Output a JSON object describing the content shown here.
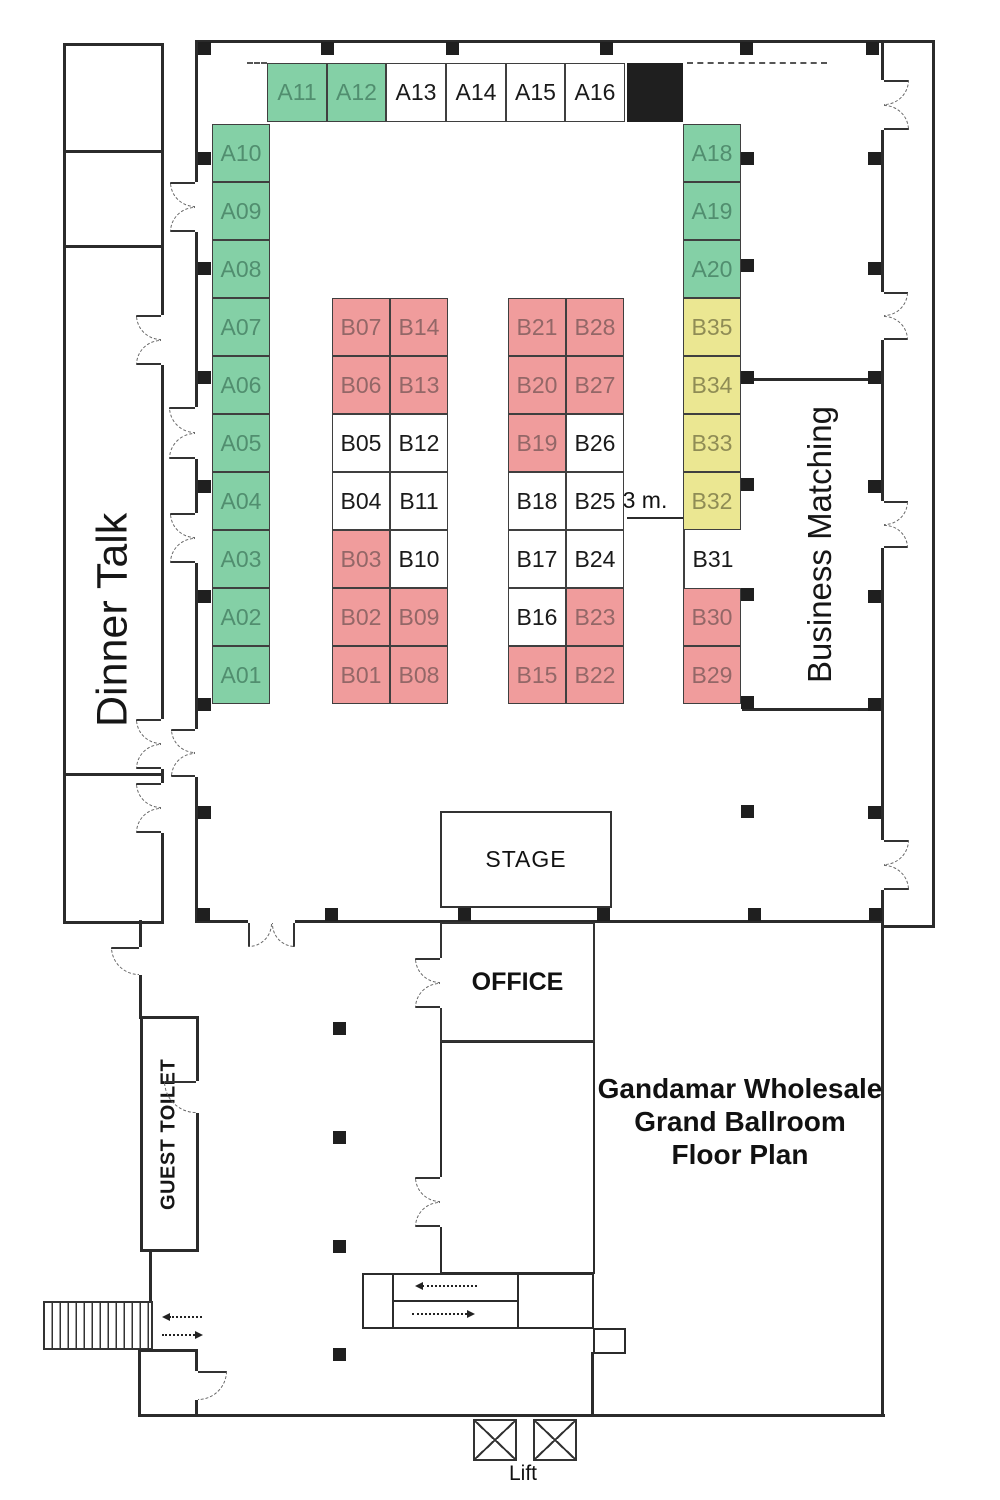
{
  "title": {
    "lines": [
      "Gandamar Wholesale",
      "Grand Ballroom",
      "Floor Plan"
    ]
  },
  "labels": {
    "dinner_talk": "Dinner Talk",
    "business_matching": "Business Matching",
    "guest_toilet": "GUEST TOILET",
    "stage": "STAGE",
    "office": "OFFICE",
    "lift": "Lift",
    "aisle_width": "3 m."
  },
  "colors": {
    "wall": "#2b2b2b",
    "solid_block": "#1f1f1f",
    "booth_green": "#84d0a6",
    "booth_green_text": "#518e6f",
    "booth_pink": "#f09c9c",
    "booth_pink_text": "#936767",
    "booth_yellow": "#ebe792",
    "booth_yellow_text": "#8f8c55"
  },
  "booths": [
    {
      "id": "A11",
      "x": 267,
      "y": 63,
      "w": 60,
      "h": 59,
      "type": "green"
    },
    {
      "id": "A12",
      "x": 327,
      "y": 63,
      "w": 59,
      "h": 59,
      "type": "green"
    },
    {
      "id": "A13",
      "x": 386,
      "y": 63,
      "w": 60,
      "h": 59,
      "type": "white"
    },
    {
      "id": "A14",
      "x": 446,
      "y": 63,
      "w": 60,
      "h": 59,
      "type": "white"
    },
    {
      "id": "A15",
      "x": 506,
      "y": 63,
      "w": 59,
      "h": 59,
      "type": "white"
    },
    {
      "id": "A16",
      "x": 565,
      "y": 63,
      "w": 60,
      "h": 59,
      "type": "white"
    },
    {
      "id": "",
      "x": 627,
      "y": 63,
      "w": 56,
      "h": 59,
      "type": "solid"
    },
    {
      "id": "A10",
      "x": 212,
      "y": 124,
      "w": 58,
      "h": 58,
      "type": "green"
    },
    {
      "id": "A09",
      "x": 212,
      "y": 182,
      "w": 58,
      "h": 58,
      "type": "green"
    },
    {
      "id": "A08",
      "x": 212,
      "y": 240,
      "w": 58,
      "h": 58,
      "type": "green"
    },
    {
      "id": "A07",
      "x": 212,
      "y": 298,
      "w": 58,
      "h": 58,
      "type": "green"
    },
    {
      "id": "A06",
      "x": 212,
      "y": 356,
      "w": 58,
      "h": 58,
      "type": "green"
    },
    {
      "id": "A05",
      "x": 212,
      "y": 414,
      "w": 58,
      "h": 58,
      "type": "green"
    },
    {
      "id": "A04",
      "x": 212,
      "y": 472,
      "w": 58,
      "h": 58,
      "type": "green"
    },
    {
      "id": "A03",
      "x": 212,
      "y": 530,
      "w": 58,
      "h": 58,
      "type": "green"
    },
    {
      "id": "A02",
      "x": 212,
      "y": 588,
      "w": 58,
      "h": 58,
      "type": "green"
    },
    {
      "id": "A01",
      "x": 212,
      "y": 646,
      "w": 58,
      "h": 58,
      "type": "green"
    },
    {
      "id": "A18",
      "x": 683,
      "y": 124,
      "w": 58,
      "h": 58,
      "type": "green"
    },
    {
      "id": "A19",
      "x": 683,
      "y": 182,
      "w": 58,
      "h": 58,
      "type": "green"
    },
    {
      "id": "A20",
      "x": 683,
      "y": 240,
      "w": 58,
      "h": 58,
      "type": "green"
    },
    {
      "id": "B35",
      "x": 683,
      "y": 298,
      "w": 58,
      "h": 58,
      "type": "yellow"
    },
    {
      "id": "B34",
      "x": 683,
      "y": 356,
      "w": 58,
      "h": 58,
      "type": "yellow"
    },
    {
      "id": "B33",
      "x": 683,
      "y": 414,
      "w": 58,
      "h": 58,
      "type": "yellow"
    },
    {
      "id": "B32",
      "x": 683,
      "y": 472,
      "w": 58,
      "h": 58,
      "type": "yellow"
    },
    {
      "id": "B31",
      "x": 683,
      "y": 530,
      "w": 58,
      "h": 58,
      "type": "open"
    },
    {
      "id": "B30",
      "x": 683,
      "y": 588,
      "w": 58,
      "h": 58,
      "type": "pink"
    },
    {
      "id": "B29",
      "x": 683,
      "y": 646,
      "w": 58,
      "h": 58,
      "type": "pink"
    },
    {
      "id": "B07",
      "x": 332,
      "y": 298,
      "w": 58,
      "h": 58,
      "type": "pink"
    },
    {
      "id": "B14",
      "x": 390,
      "y": 298,
      "w": 58,
      "h": 58,
      "type": "pink"
    },
    {
      "id": "B06",
      "x": 332,
      "y": 356,
      "w": 58,
      "h": 58,
      "type": "pink"
    },
    {
      "id": "B13",
      "x": 390,
      "y": 356,
      "w": 58,
      "h": 58,
      "type": "pink"
    },
    {
      "id": "B05",
      "x": 332,
      "y": 414,
      "w": 58,
      "h": 58,
      "type": "white"
    },
    {
      "id": "B12",
      "x": 390,
      "y": 414,
      "w": 58,
      "h": 58,
      "type": "white"
    },
    {
      "id": "B04",
      "x": 332,
      "y": 472,
      "w": 58,
      "h": 58,
      "type": "white"
    },
    {
      "id": "B11",
      "x": 390,
      "y": 472,
      "w": 58,
      "h": 58,
      "type": "white"
    },
    {
      "id": "B03",
      "x": 332,
      "y": 530,
      "w": 58,
      "h": 58,
      "type": "pink"
    },
    {
      "id": "B10",
      "x": 390,
      "y": 530,
      "w": 58,
      "h": 58,
      "type": "white"
    },
    {
      "id": "B02",
      "x": 332,
      "y": 588,
      "w": 58,
      "h": 58,
      "type": "pink"
    },
    {
      "id": "B09",
      "x": 390,
      "y": 588,
      "w": 58,
      "h": 58,
      "type": "pink"
    },
    {
      "id": "B01",
      "x": 332,
      "y": 646,
      "w": 58,
      "h": 58,
      "type": "pink"
    },
    {
      "id": "B08",
      "x": 390,
      "y": 646,
      "w": 58,
      "h": 58,
      "type": "pink"
    },
    {
      "id": "B21",
      "x": 508,
      "y": 298,
      "w": 58,
      "h": 58,
      "type": "pink"
    },
    {
      "id": "B28",
      "x": 566,
      "y": 298,
      "w": 58,
      "h": 58,
      "type": "pink"
    },
    {
      "id": "B20",
      "x": 508,
      "y": 356,
      "w": 58,
      "h": 58,
      "type": "pink"
    },
    {
      "id": "B27",
      "x": 566,
      "y": 356,
      "w": 58,
      "h": 58,
      "type": "pink"
    },
    {
      "id": "B19",
      "x": 508,
      "y": 414,
      "w": 58,
      "h": 58,
      "type": "pink"
    },
    {
      "id": "B26",
      "x": 566,
      "y": 414,
      "w": 58,
      "h": 58,
      "type": "white"
    },
    {
      "id": "B18",
      "x": 508,
      "y": 472,
      "w": 58,
      "h": 58,
      "type": "white"
    },
    {
      "id": "B25",
      "x": 566,
      "y": 472,
      "w": 58,
      "h": 58,
      "type": "white"
    },
    {
      "id": "B17",
      "x": 508,
      "y": 530,
      "w": 58,
      "h": 58,
      "type": "white"
    },
    {
      "id": "B24",
      "x": 566,
      "y": 530,
      "w": 58,
      "h": 58,
      "type": "white"
    },
    {
      "id": "B16",
      "x": 508,
      "y": 588,
      "w": 58,
      "h": 58,
      "type": "white"
    },
    {
      "id": "B23",
      "x": 566,
      "y": 588,
      "w": 58,
      "h": 58,
      "type": "pink"
    },
    {
      "id": "B15",
      "x": 508,
      "y": 646,
      "w": 58,
      "h": 58,
      "type": "pink"
    },
    {
      "id": "B22",
      "x": 566,
      "y": 646,
      "w": 58,
      "h": 58,
      "type": "pink"
    }
  ],
  "pillars": [
    [
      198,
      42
    ],
    [
      321,
      42
    ],
    [
      446,
      42
    ],
    [
      600,
      42
    ],
    [
      740,
      42
    ],
    [
      866,
      42
    ],
    [
      197,
      908
    ],
    [
      325,
      908
    ],
    [
      458,
      908
    ],
    [
      597,
      908
    ],
    [
      748,
      908
    ],
    [
      869,
      908
    ],
    [
      198,
      152
    ],
    [
      198,
      262
    ],
    [
      198,
      371
    ],
    [
      198,
      480
    ],
    [
      198,
      590
    ],
    [
      198,
      698
    ],
    [
      198,
      806
    ],
    [
      868,
      152
    ],
    [
      868,
      262
    ],
    [
      868,
      371
    ],
    [
      868,
      480
    ],
    [
      868,
      590
    ],
    [
      868,
      698
    ],
    [
      868,
      806
    ],
    [
      741,
      152
    ],
    [
      741,
      259
    ],
    [
      741,
      371
    ],
    [
      741,
      478
    ],
    [
      741,
      588
    ],
    [
      741,
      696
    ],
    [
      741,
      805
    ],
    [
      333,
      1022
    ],
    [
      333,
      1131
    ],
    [
      333,
      1240
    ],
    [
      333,
      1348
    ]
  ],
  "doors": [
    {
      "x": 881,
      "y": 80,
      "len": 50,
      "dir": "e"
    },
    {
      "x": 881,
      "y": 292,
      "len": 48,
      "dir": "e"
    },
    {
      "x": 881,
      "y": 501,
      "len": 47,
      "dir": "e"
    },
    {
      "x": 881,
      "y": 840,
      "len": 50,
      "dir": "e"
    },
    {
      "x": 195,
      "y": 182,
      "len": 50,
      "dir": "w"
    },
    {
      "x": 195,
      "y": 407,
      "len": 52,
      "dir": "w"
    },
    {
      "x": 195,
      "y": 513,
      "len": 50,
      "dir": "w"
    },
    {
      "x": 195,
      "y": 729,
      "len": 48,
      "dir": "w"
    },
    {
      "x": 161,
      "y": 315,
      "len": 50,
      "dir": "w"
    },
    {
      "x": 161,
      "y": 719,
      "len": 50,
      "dir": "w"
    },
    {
      "x": 161,
      "y": 783,
      "len": 50,
      "dir": "w"
    },
    {
      "x": 248,
      "y": 920,
      "len": 47,
      "dir": "s"
    },
    {
      "x": 139,
      "y": 947,
      "len": 28,
      "dir": "w",
      "single": true
    },
    {
      "x": 440,
      "y": 958,
      "len": 50,
      "dir": "w"
    },
    {
      "x": 440,
      "y": 1177,
      "len": 50,
      "dir": "w"
    },
    {
      "x": 196,
      "y": 1081,
      "len": 32,
      "dir": "w",
      "single": true
    },
    {
      "x": 195,
      "y": 1371,
      "len": 29,
      "dir": "e",
      "single": true
    }
  ],
  "arrows": [
    {
      "x": 415,
      "y": 1285,
      "len": 62,
      "dir": "left"
    },
    {
      "x": 412,
      "y": 1313,
      "len": 62,
      "dir": "right"
    },
    {
      "x": 162,
      "y": 1316,
      "len": 40,
      "dir": "left"
    },
    {
      "x": 162,
      "y": 1334,
      "len": 40,
      "dir": "right"
    }
  ]
}
